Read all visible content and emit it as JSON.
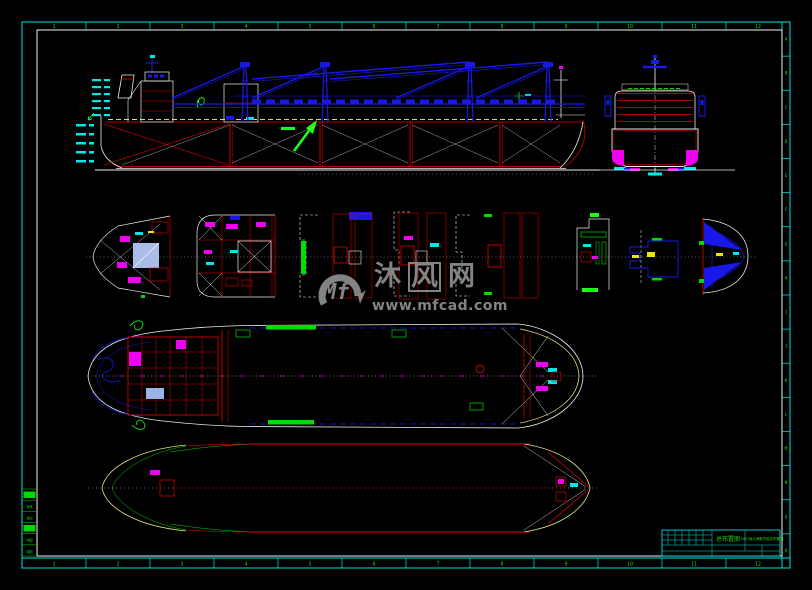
{
  "frame": {
    "ruler_numbers": [
      "1",
      "2",
      "3",
      "4",
      "5",
      "6",
      "7",
      "8",
      "9",
      "10",
      "11",
      "12"
    ],
    "edge_letters": [
      "A",
      "B",
      "C",
      "D",
      "E",
      "F",
      "G",
      "H",
      "I",
      "J",
      "K",
      "L",
      "M",
      "N",
      "O",
      "P"
    ],
    "number_color": "#1fce1f",
    "border_color": "#00dede",
    "inner_border_color": "#f2f2f2"
  },
  "watermark": {
    "logo": "Mf",
    "char1": "沐",
    "char2": "风",
    "char3": "网",
    "url": "www.mfcad.com",
    "color": "#8d8d8d"
  },
  "views": {
    "sections": {
      "titles": [
        "1-1",
        "2-2",
        "3-3",
        "4-4",
        "5-5",
        "6-6",
        "7-7",
        "8-8"
      ]
    },
    "deck_plan": {
      "bay_labels": [
        "3号舱",
        "2号舱",
        "1号舱"
      ]
    },
    "hold_plan": {
      "hold_labels": [
        "5号货舱",
        "4号货舱",
        "3号货舱",
        "2号货舱",
        "1号货舱"
      ]
    }
  },
  "spec_table": {
    "title_line1": "主要量度",
    "title_line2": "及主要设备表",
    "rows": [
      {
        "label": "总长",
        "value": "45.80 m"
      },
      {
        "label": "垂线间长",
        "value": "42.00 m"
      },
      {
        "label": "型宽",
        "value": "8.60 m"
      },
      {
        "label": "型深",
        "value": "3.20 m"
      },
      {
        "label": "设计吃水",
        "value": "2.60 m"
      },
      {
        "label": "排水量",
        "value": "680 t"
      },
      {
        "label": "载重量  满载",
        "value": "500 t"
      },
      {
        "label": "主机型号",
        "value": "6135Ca"
      },
      {
        "label": "主机功率",
        "value": "2×99 kW"
      },
      {
        "label": "航速",
        "value": "9.5 kn"
      },
      {
        "label": "载货量 散货,杂货",
        "value": "500 t"
      },
      {
        "label": "压载水",
        "value": "60 t"
      },
      {
        "label": "燃油 淡水",
        "value": "8.0/6.0 t"
      }
    ]
  },
  "title_block": {
    "title": "总布置图",
    "subtitle": "500T级沿海散货船总布置图",
    "fields": [
      "设计",
      "制图",
      "审核",
      "标检"
    ],
    "notes": [
      "比例 1:100",
      "重量",
      "图号 01",
      "共1张"
    ]
  },
  "left_table": {
    "rows": [
      "批准",
      "审核",
      "校对",
      "设计",
      "制图",
      "描图"
    ]
  },
  "colors": {
    "cyan": "#00e8e8",
    "green": "#00d800",
    "bright_green": "#18ff18",
    "blue": "#1818e8",
    "red": "#e80000",
    "magenta": "#f000f0",
    "white": "#ededed",
    "yellow": "#e8e800",
    "khaki": "#e0dc7a",
    "steel": "#9ab4e6",
    "gray": "#b4b4b4"
  }
}
